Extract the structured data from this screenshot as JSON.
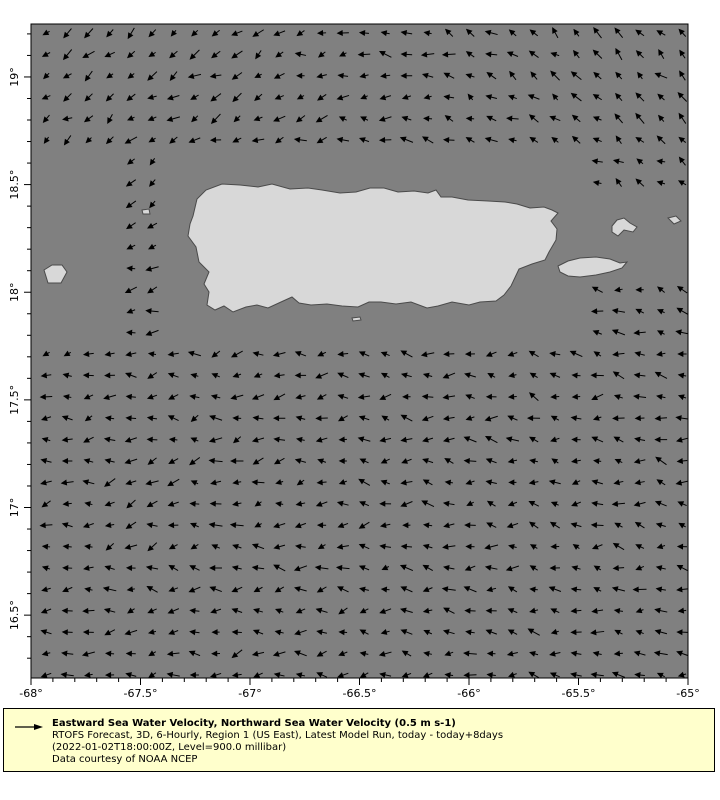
{
  "figure": {
    "width": 720,
    "height": 800,
    "background": "#ffffff"
  },
  "chart_data": {
    "type": "vector-map",
    "title": "Eastward Sea Water Velocity, Northward Sea Water Velocity (0.5 m s-1)",
    "region": "Puerto Rico and surrounding ocean",
    "lon_ticks": [
      -68,
      -67.5,
      -67,
      -66.5,
      -66,
      -65.5,
      -65
    ],
    "lat_ticks": [
      19,
      18.5,
      18,
      17.5,
      17,
      16.5
    ],
    "lon_range": [
      -68,
      -65
    ],
    "lat_range": [
      16.21,
      19.25
    ],
    "reference_vector": "0.5 m s-1",
    "flow_summary": "dense grid of small black current arrows over ocean, predominantly westward with southward drift in northwest and northwestward drift in northeast; no arrows over land or coastal shelf"
  },
  "map": {
    "plot": {
      "left": 31,
      "top": 24,
      "right": 688,
      "bottom": 678
    },
    "colors": {
      "ocean": "#808080",
      "land": "#d8d8d8",
      "land_edge": "#4a4a4a",
      "frame": "#000000",
      "arrow": "#000000",
      "label": "#000000"
    },
    "axes": {
      "lon_left": -68,
      "lon_right": -65,
      "lat_top": 19.246,
      "lat_bottom": 16.208,
      "x_tick_labels": [
        "-68°",
        "-67.5°",
        "-67°",
        "-66.5°",
        "-66°",
        "-65.5°",
        "-65°"
      ],
      "x_tick_lons": [
        -68,
        -67.5,
        -67,
        -66.5,
        -66,
        -65.5,
        -65
      ],
      "y_tick_labels": [
        "19°",
        "18.5°",
        "18°",
        "17.5°",
        "17°",
        "16.5°"
      ],
      "y_tick_lats": [
        19,
        18.5,
        18,
        17.5,
        17,
        16.5
      ],
      "minor_step_deg": 0.1,
      "major_tick_len": 7,
      "minor_tick_len": 4,
      "label_font_px": 11
    },
    "islands": [
      {
        "name": "island-puerto-rico",
        "points": [
          [
            193,
            216
          ],
          [
            197,
            199
          ],
          [
            206,
            190
          ],
          [
            222,
            184
          ],
          [
            240,
            185
          ],
          [
            258,
            187
          ],
          [
            272,
            184
          ],
          [
            290,
            189
          ],
          [
            308,
            188
          ],
          [
            322,
            190
          ],
          [
            340,
            193
          ],
          [
            356,
            192
          ],
          [
            370,
            188
          ],
          [
            384,
            188
          ],
          [
            398,
            192
          ],
          [
            414,
            191
          ],
          [
            428,
            193
          ],
          [
            436,
            190
          ],
          [
            441,
            197
          ],
          [
            452,
            197
          ],
          [
            468,
            200
          ],
          [
            488,
            201
          ],
          [
            505,
            202
          ],
          [
            517,
            204
          ],
          [
            530,
            208
          ],
          [
            544,
            207
          ],
          [
            552,
            210
          ],
          [
            558,
            213
          ],
          [
            551,
            221
          ],
          [
            557,
            229
          ],
          [
            556,
            240
          ],
          [
            549,
            252
          ],
          [
            545,
            260
          ],
          [
            532,
            264
          ],
          [
            519,
            269
          ],
          [
            511,
            286
          ],
          [
            504,
            295
          ],
          [
            496,
            301
          ],
          [
            480,
            302
          ],
          [
            469,
            305
          ],
          [
            452,
            302
          ],
          [
            438,
            306
          ],
          [
            427,
            308
          ],
          [
            411,
            302
          ],
          [
            396,
            304
          ],
          [
            381,
            302
          ],
          [
            369,
            302
          ],
          [
            358,
            307
          ],
          [
            342,
            306
          ],
          [
            327,
            304
          ],
          [
            311,
            305
          ],
          [
            299,
            303
          ],
          [
            292,
            297
          ],
          [
            281,
            302
          ],
          [
            268,
            308
          ],
          [
            257,
            305
          ],
          [
            246,
            307
          ],
          [
            233,
            312
          ],
          [
            224,
            306
          ],
          [
            215,
            310
          ],
          [
            207,
            305
          ],
          [
            209,
            292
          ],
          [
            204,
            284
          ],
          [
            209,
            272
          ],
          [
            199,
            262
          ],
          [
            196,
            247
          ],
          [
            188,
            236
          ],
          [
            190,
            224
          ]
        ]
      },
      {
        "name": "island-mona",
        "points": [
          [
            44,
            270
          ],
          [
            52,
            265
          ],
          [
            62,
            265
          ],
          [
            67,
            272
          ],
          [
            61,
            283
          ],
          [
            48,
            283
          ]
        ]
      },
      {
        "name": "island-desecheo",
        "points": [
          [
            142,
            210
          ],
          [
            149,
            209
          ],
          [
            150,
            214
          ],
          [
            143,
            214
          ]
        ]
      },
      {
        "name": "island-vieques",
        "points": [
          [
            558,
            266
          ],
          [
            568,
            261
          ],
          [
            580,
            258
          ],
          [
            596,
            257
          ],
          [
            610,
            259
          ],
          [
            620,
            263
          ],
          [
            627,
            262
          ],
          [
            622,
            268
          ],
          [
            610,
            272
          ],
          [
            596,
            275
          ],
          [
            580,
            277
          ],
          [
            568,
            276
          ],
          [
            560,
            272
          ]
        ]
      },
      {
        "name": "island-culebra",
        "points": [
          [
            612,
            226
          ],
          [
            617,
            220
          ],
          [
            624,
            218
          ],
          [
            630,
            223
          ],
          [
            637,
            227
          ],
          [
            633,
            232
          ],
          [
            624,
            230
          ],
          [
            618,
            236
          ],
          [
            612,
            232
          ]
        ]
      },
      {
        "name": "island-culebrita",
        "points": [
          [
            668,
            218
          ],
          [
            676,
            216
          ],
          [
            681,
            221
          ],
          [
            674,
            224
          ]
        ]
      },
      {
        "name": "islet-south",
        "points": [
          [
            352,
            318
          ],
          [
            360,
            317
          ],
          [
            361,
            320
          ],
          [
            353,
            321
          ]
        ]
      }
    ],
    "vector_grid": {
      "x0": 46.5,
      "y0": 33,
      "dx": 21.2,
      "dy": 21.4,
      "cols": 31,
      "rows": 31,
      "min_len": 7,
      "len_var": 6,
      "head_len": 4.5,
      "head_half_width": 2.2
    },
    "mask_rects": [
      [
        31,
        150,
        83,
        188
      ],
      [
        168,
        158,
        414,
        187
      ],
      [
        582,
        185,
        107,
        87
      ]
    ]
  },
  "legend": {
    "background": "#ffffcc",
    "border_color": "#000000",
    "reference_arrow_icon": "right-arrow",
    "title": "Eastward Sea Water Velocity, Northward Sea Water Velocity (0.5 m s-1)",
    "line2": "RTOFS Forecast, 3D, 6-Hourly, Region 1 (US East), Latest Model Run, today - today+8days",
    "line3": "(2022-01-02T18:00:00Z, Level=900.0 millibar)",
    "line4": "Data courtesy of NOAA NCEP"
  }
}
